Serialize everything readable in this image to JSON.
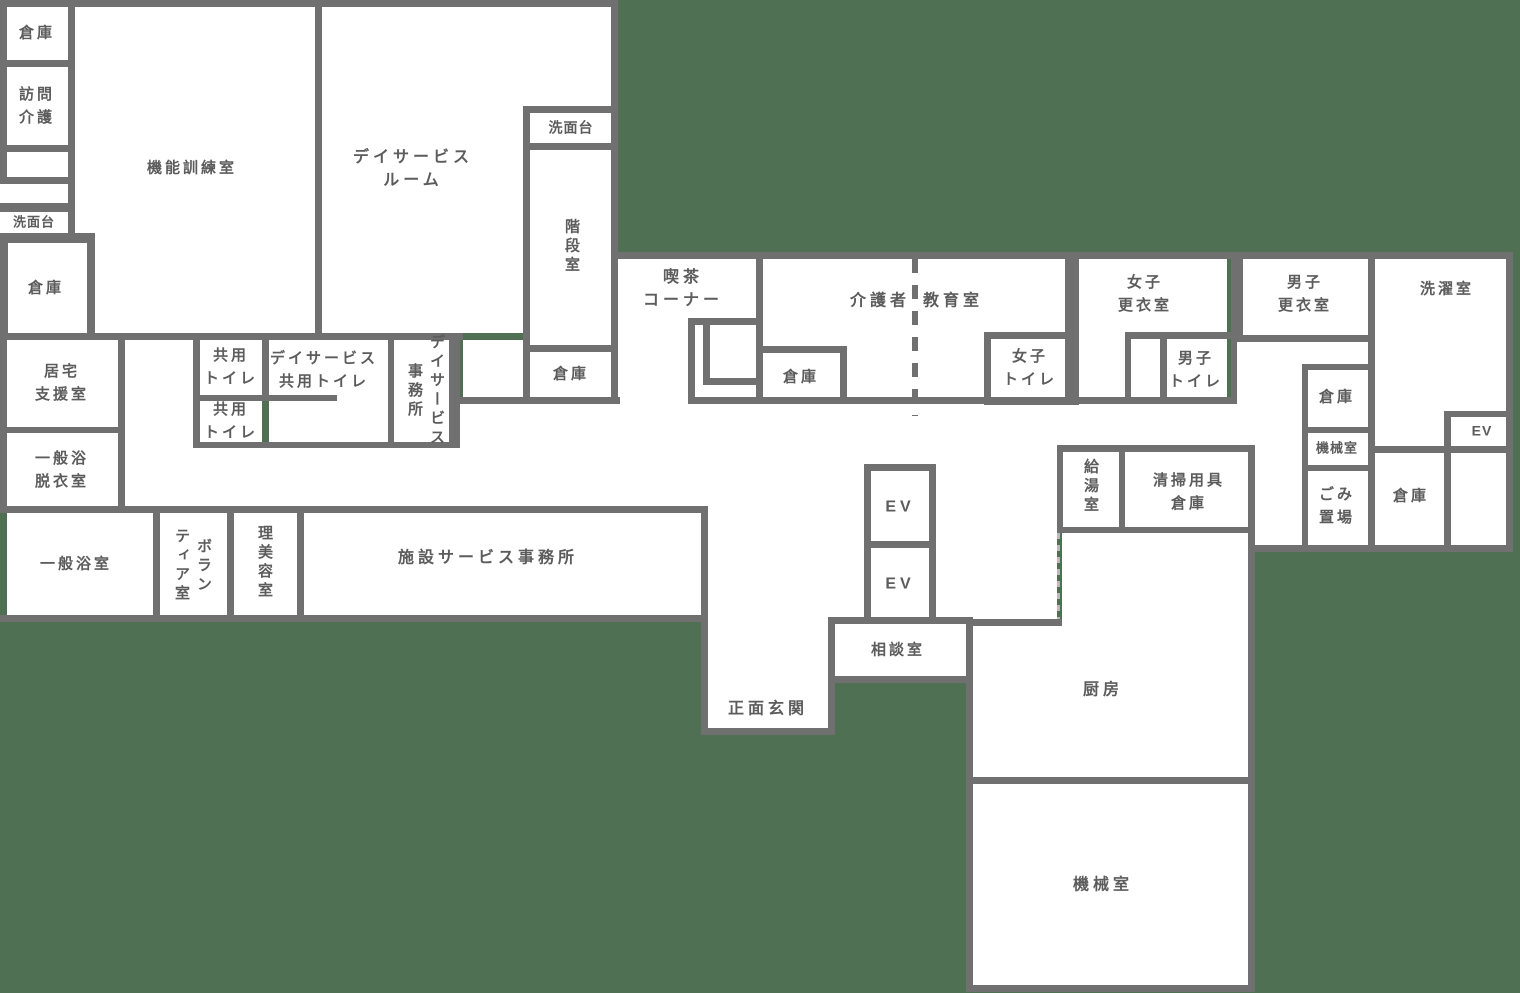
{
  "palette": {
    "background_green": "#4f7053",
    "wall_gray": "#707070",
    "room_white": "#ffffff",
    "label_gray": "#5c5c5c",
    "dashed_line_dark": "#707070",
    "dashed_line_light": "#b9b9b9"
  },
  "rooms": {
    "storage_top_left": {
      "label": "倉庫"
    },
    "home_visit_care": {
      "label": "訪問\n介護"
    },
    "washstand_left": {
      "label": "洗面台"
    },
    "storage_left_2": {
      "label": "倉庫"
    },
    "function_training_room": {
      "label": "機能訓練室"
    },
    "day_service_room": {
      "label": "デイサービス\nルーム"
    },
    "washstand_stair": {
      "label": "洗面台"
    },
    "stairwell": {
      "label": "階段室"
    },
    "storage_stair": {
      "label": "倉庫"
    },
    "home_support_room": {
      "label": "居宅\n支援室"
    },
    "general_bath_dressing_room": {
      "label": "一般浴\n脱衣室"
    },
    "shared_toilet_1": {
      "label": "共用\nトイレ"
    },
    "day_service_shared_toilet": {
      "label": "デイサービス\n共用トイレ"
    },
    "shared_toilet_2": {
      "label": "共用\nトイレ"
    },
    "day_service_office": {
      "label": "デイサービス\n事務所"
    },
    "general_bathroom": {
      "label": "一般浴室"
    },
    "volunteer_room": {
      "label": "ボラン\nティア室"
    },
    "barber_beauty_room": {
      "label": "理美容室"
    },
    "facility_service_office": {
      "label": "施設サービス事務所"
    },
    "cafe_corner": {
      "label": "喫茶\nコーナー"
    },
    "caregiver": {
      "label": "介護者"
    },
    "education_room": {
      "label": "教育室"
    },
    "storage_mid": {
      "label": "倉庫"
    },
    "womens_toilet": {
      "label": "女子\nトイレ"
    },
    "womens_locker_room": {
      "label": "女子\n更衣室"
    },
    "mens_locker_room": {
      "label": "男子\n更衣室"
    },
    "mens_toilet": {
      "label": "男子\nトイレ"
    },
    "laundry_room": {
      "label": "洗濯室"
    },
    "storage_right_1": {
      "label": "倉庫"
    },
    "machine_room_small": {
      "label": "機械室"
    },
    "garbage_area": {
      "label": "ごみ\n置場"
    },
    "storage_right_2": {
      "label": "倉庫"
    },
    "elevator_right": {
      "label": "EV"
    },
    "elevator_1": {
      "label": "EV"
    },
    "elevator_2": {
      "label": "EV"
    },
    "consultation_room": {
      "label": "相談室"
    },
    "hot_water_room": {
      "label": "給湯室"
    },
    "cleaning_supplies_storage": {
      "label": "清掃用具\n倉庫"
    },
    "main_entrance": {
      "label": "正面玄関"
    },
    "kitchen": {
      "label": "厨房"
    },
    "machine_room_large": {
      "label": "機械室"
    }
  }
}
